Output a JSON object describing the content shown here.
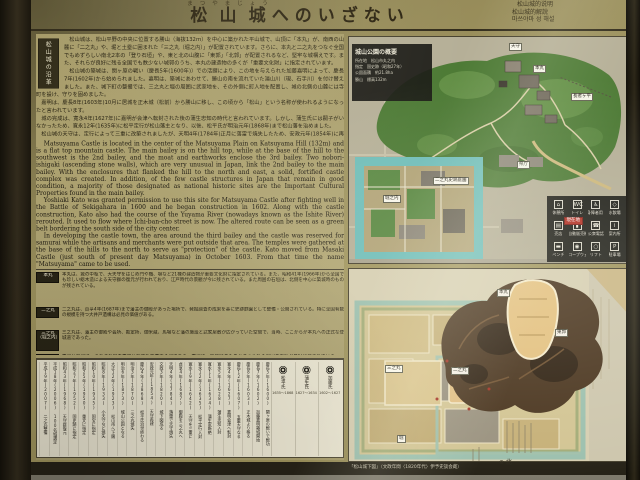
{
  "title": {
    "furigana": "まつやまじょう",
    "kanji": "松山城",
    "suffix": "へのいざない"
  },
  "translations": [
    "松山城的说明",
    "松山城的解說",
    "마쓰야마 성 해설"
  ],
  "history": {
    "sidebar_label": "松山城の沿革",
    "jp_paragraphs": [
      "松山城は、松山平野の中央に位置する勝山（海抜132ｍ）を中心に築かれた平山城で、山頂に「本丸」が、南西の山麓に「二之丸」や、堀と土塁に囲まれた「三之丸（堀之内）」が配置されています。さらに、本丸と二之丸をつなぐ全国でもめずらしい南北2本の「登り石垣」や、東と北の山腹に「東郭」「北郭」が配置されるなど、堅牢な城構えです。また、それらが良好に残る全国でも数少ない城郭のうち、本丸の建造物の多くが「重要文化財」に指定されています。",
      "松山城の築城は、関ヶ原の戦い（慶長5年(1600年)）での活躍により、この地を与えられた加藤嘉明によって、慶長7年(1602年)から始められました。嘉明は、築城にあわせて、勝山の南を流れていた湯山川（現、石手川）を付け替えました。また、城下町の整備では、三之丸と堀の周囲に武家地を、その外側に町人地を配置し、城の北側の山麓には寺町を設け、守りを固めました。",
      "嘉明は、慶長8年(1603年)10月に居城を正木城（松前）から勝山に移し、この頃から「松山」という名称が使われるようになったと言われています。",
      "城の完成は、寛永4年(1627年)に嘉明が会津へ転封された後の蒲生忠知の時代と言われています。しかし、蒲生氏には嗣子がいなかったため、寛永12年(1635年)に松平定行が松山藩主となり、以後、松平氏が明治元年(1868年)まで松山藩を治めました。",
      "松山城の天守は、定行によって三重に改築されましたが、天明4年(1784年)正月に落雷で焼失したため、安政元年(1854年)に再建されました。"
    ],
    "en_paragraphs": [
      "Matsuyama Castle is located in the center of the Matsuyama Plain on Katsuyama Hill (132m) and is a flat top mountain castle. The main bailey is on the hill top, while at the base of the hill to the southwest is the 2nd bailey, and the moat and earthworks enclose the 3rd bailey. Two nobori-ishigaki (ascending stone walls), which are very unusual in Japan, link the 2nd bailey to the main bailey. With the enclosures that flanked the hill to the north and east, a solid, fortified castle complex was created. In addition, of the few castle structures in Japan that remain in good condition, a majority of those designated as national historic sites are the Important Cultural Properties found in the main bailey.",
      "Yoshiaki Kato was granted permission to use this site for Matsuyama Castle after fighting well in the Battle of Sekigahara in 1600 and he began construction in 1602. Along with the castle construction, Kato also had the course of the Yuyama River (nowadays known as the Ishite River) rerouted. It used to flow where Ichi-ban-cho street is now. The altered route can be seen as a green belt bordering the south side of the city center.",
      "In developing the castle town, the area around the third bailey and the castle was reserved for samurai while the artisans and merchants were put outside that area. The temples were gathered at the base of the hills to the north to serve as \"protection\" of the castle. Kato moved from Masaki Castle (just south of present day Matsuyama) in October 1603. From that time the name \"Matsuyama\" came to be used.",
      "It is said that the building of the castle was completed by Tadachika Gamo after Kato Yoshiaki was transferred to Aizu in 1627. Gamo died without an heir, so in 1635 Sadayuki Matsudaira became the lord of Matsuyama domain. The Matsudaira clan continued to serve Matsuyama domain until 1868.",
      "The main tower of Matsuyama Castle was rebuilt in three stories by Sadayuki Matsudaira, but in January 1784, it was struck by lightning and burned to the ground. It was rebuilt in 1854."
    ]
  },
  "sections": [
    {
      "label": "本丸",
      "text": "本丸は、城の中枢で、大天守をはじめ門や櫓、塀など21棟の建造物が重要文化財に指定されている。また、昭和41年(1966年)から全国でも珍しい総木造による天守群の復元が行われており、江戸時代の景観が今に残されている。また周囲の石垣は、北側を中心に築城時のものが残されている。"
    },
    {
      "label": "二之丸",
      "text": "二之丸は、貞享4年(1687年)まで藩主の御殿があった場所で、発掘調査の成果を基に史跡庭園として整備・公開されている。特に全国有数の規模を持つ大井戸遺構は必見の価値がある。"
    },
    {
      "label": "三之丸（堀之内）",
      "text": "三之丸は、藩主の御殿や会所、勘定所、御米蔵、馬場など藩の施設と武家屋敷が広がっていた空間で、当時、ここからが本丸への正式な登城道であった。"
    },
    {
      "label": "東郭・北郭",
      "text": "東郭と北郭は、それぞれ城の東側と北側を防備する郭である。東郭は、築城時のものと考えられる周囲の石垣が良好に残されている。一方、北郭は、そのほとんどが壊されているが、石垣の一部が山麓に残されている。"
    },
    {
      "label": "その他の城郭遺構",
      "text": "城内の北登り石垣や三之丸の堀や土塁、内堀、城下町の境界にあったと言われている堀や土塁などは、近代以降の改変で消失したが、地形や街の区画にその名残をとどめている。"
    }
  ],
  "timeline": {
    "clans": [
      {
        "name": "加藤氏",
        "years": "1602〜1627"
      },
      {
        "name": "蒲生氏",
        "years": "1627〜1634"
      },
      {
        "name": "松平氏",
        "years": "1635〜1868"
      }
    ],
    "entries": [
      "慶長5年(1600) 関ヶ原の戦いで戦功",
      "慶長7年(1602) 加藤嘉明築城開始",
      "慶長8年(1603) 正木城より移る",
      "慶長12年(1607) 五重天守なる",
      "寛永4年(1627) 嘉明会津へ転封",
      "寛永5年(1628) 蒲生忠知入封",
      "寛永11年(1634) 蒲生家断絶",
      "寛永12年(1635) 松平定行入封",
      "寛永19年(1642) 天守を三重に",
      "貞享4年(1687) 御殿を三之丸へ",
      "天明4年(1784) 落雷で天守焼失",
      "文政3年(1820) 城下図成る",
      "安政元年(1854) 天守再建",
      "慶応4年(1868) 松平氏治世終わる",
      "明治3年(1870) 三之丸焼失",
      "明治6年(1873) 城山公園となる",
      "大正12年(1923) 松山市へ下賜",
      "昭和8年(1933) 小天守など焼失",
      "昭和10年(1935) 国宝に指定",
      "昭和25年(1950) 重文に指定",
      "昭和27年(1952) 国史跡に指定",
      "昭和43年(1968) 天守群復元",
      "平成18年(2006) 100名城選定",
      "平成19年(2007) 二之丸整備"
    ]
  },
  "park_map": {
    "title": "城山公園の概要",
    "info_lines": [
      "所在地　松山市丸之内",
      "指定　国史跡（昭和27年）",
      "公園面積　約21.8ha",
      "勝山　標高132m"
    ],
    "labels": [
      "天守",
      "本丸",
      "長者ヶ平",
      "県庁",
      "二之丸史跡庭園",
      "堀之内"
    ],
    "current_location": "現在地",
    "legend": [
      {
        "glyph": "⌂",
        "label": "休憩所"
      },
      {
        "glyph": "WC",
        "label": "トイレ"
      },
      {
        "glyph": "♿",
        "label": "身障者用トイレ"
      },
      {
        "glyph": "◇",
        "label": "水飲場"
      },
      {
        "glyph": "▤",
        "label": "売店"
      },
      {
        "glyph": "▮",
        "label": "自動販売機"
      },
      {
        "glyph": "☎",
        "label": "公衆電話"
      },
      {
        "glyph": "i",
        "label": "案内所"
      },
      {
        "glyph": "▬",
        "label": "ベンチ"
      },
      {
        "glyph": "◉",
        "label": "ロープウェイ"
      },
      {
        "glyph": "○",
        "label": "リフト"
      },
      {
        "glyph": "P",
        "label": "駐車場"
      }
    ]
  },
  "old_map": {
    "labels": [
      "本丸",
      "東郭",
      "二之丸",
      "三之丸",
      "堀"
    ],
    "caption": "「松山城下図」（文政年間〈1820年代〉伊予史談会蔵）",
    "compass": "⊕ 北"
  }
}
